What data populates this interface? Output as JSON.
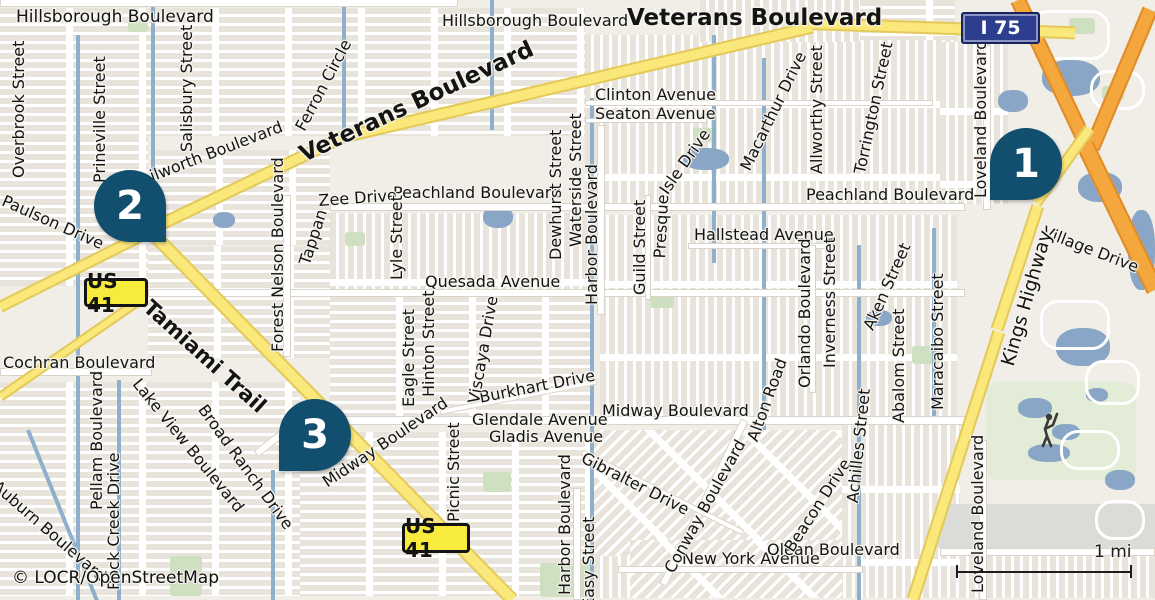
{
  "map": {
    "attribution": "© LOCR/OpenStreetMap",
    "scale_label": "1 mi",
    "colors": {
      "background": "#f1eee8",
      "block": "#e8e4db",
      "road_white": "#ffffff",
      "highway_yellow": "#fbe87a",
      "motorway_orange": "#f4a73d",
      "water": "#8fb0cc",
      "green": "#cfdfc2",
      "marker_blue": "#124e6e",
      "us_shield_bg": "#f7ec3d",
      "interstate_shield_bg": "#2e3e8e",
      "label_color": "#141414"
    },
    "shields": [
      {
        "name": "route-shield-us41-north",
        "label": "US 41",
        "type": "us",
        "x": 84,
        "y": 278,
        "w": 64,
        "h": 29
      },
      {
        "name": "route-shield-us41-south",
        "label": "US 41",
        "type": "us",
        "x": 402,
        "y": 523,
        "w": 68,
        "h": 30
      },
      {
        "name": "route-shield-i75",
        "label": "I 75",
        "type": "interstate",
        "x": 961,
        "y": 12,
        "w": 79,
        "h": 32
      }
    ],
    "markers": [
      {
        "name": "map-marker-1",
        "number": "1",
        "x": 990,
        "y": 128,
        "tail": "left"
      },
      {
        "name": "map-marker-2",
        "number": "2",
        "x": 94,
        "y": 170,
        "tail": "right"
      },
      {
        "name": "map-marker-3",
        "number": "3",
        "x": 279,
        "y": 399,
        "tail": "left"
      }
    ],
    "labels": [
      {
        "text": "Hillsborough Boulevard",
        "x": 16,
        "y": 9,
        "rot": 0,
        "size": 17
      },
      {
        "text": "Hillsborough Boulevard",
        "x": 442,
        "y": 13,
        "rot": 0,
        "size": 16
      },
      {
        "text": "Veterans Boulevard",
        "x": 627,
        "y": 6,
        "rot": 0,
        "size": 23,
        "bold": true,
        "name": "road-label-veterans-top"
      },
      {
        "text": "Veterans Boulevard",
        "x": 296,
        "y": 145,
        "rot": -25,
        "size": 23,
        "bold": true,
        "name": "road-label-veterans-diag"
      },
      {
        "text": "Clinton Avenue",
        "x": 595,
        "y": 87,
        "rot": 0,
        "size": 16
      },
      {
        "text": "Seaton Avenue",
        "x": 595,
        "y": 106,
        "rot": 0,
        "size": 16
      },
      {
        "text": "Peachland Boulevard",
        "x": 393,
        "y": 185,
        "rot": 0,
        "size": 16
      },
      {
        "text": "Peachland Boulevard",
        "x": 806,
        "y": 187,
        "rot": 0,
        "size": 16
      },
      {
        "text": "Quesada Avenue",
        "x": 425,
        "y": 274,
        "rot": 0,
        "size": 16
      },
      {
        "text": "Hallstead Avenue",
        "x": 694,
        "y": 227,
        "rot": 0,
        "size": 16
      },
      {
        "text": "Midway Boulevard",
        "x": 602,
        "y": 403,
        "rot": 0,
        "size": 16
      },
      {
        "text": "Glendale Avenue",
        "x": 472,
        "y": 412,
        "rot": 0,
        "size": 16
      },
      {
        "text": "Gladis Avenue",
        "x": 489,
        "y": 429,
        "rot": 0,
        "size": 16
      },
      {
        "text": "New York Avenue",
        "x": 682,
        "y": 551,
        "rot": 0,
        "size": 16
      },
      {
        "text": "Olean Boulevard",
        "x": 767,
        "y": 542,
        "rot": 0,
        "size": 16
      },
      {
        "text": "Cochran Boulevard",
        "x": 3,
        "y": 355,
        "rot": 0,
        "size": 16
      },
      {
        "text": "Burkhart Drive",
        "x": 478,
        "y": 390,
        "rot": -11,
        "size": 16
      },
      {
        "text": "Zee Drive",
        "x": 318,
        "y": 193,
        "rot": -4,
        "size": 16
      },
      {
        "text": "Tappan",
        "x": 297,
        "y": 262,
        "rot": -72,
        "size": 16
      },
      {
        "text": "Village Drive",
        "x": 1046,
        "y": 224,
        "rot": 21,
        "size": 16
      },
      {
        "text": "Kenilworth Boulevard",
        "x": 120,
        "y": 180,
        "rot": -21,
        "size": 16
      },
      {
        "text": "Tamiami Trail",
        "x": 154,
        "y": 296,
        "rot": 42,
        "size": 21,
        "bold": true,
        "name": "road-label-tamiami"
      },
      {
        "text": "Paulson Drive",
        "x": 6,
        "y": 193,
        "rot": 24,
        "size": 16
      },
      {
        "text": "Ferron Circle",
        "x": 293,
        "y": 126,
        "rot": -62,
        "size": 16
      },
      {
        "text": "Macarthur Drive",
        "x": 738,
        "y": 166,
        "rot": -64,
        "size": 16
      },
      {
        "text": "Torrington Street",
        "x": 852,
        "y": 172,
        "rot": -78,
        "size": 16
      },
      {
        "text": "Aken Street",
        "x": 861,
        "y": 326,
        "rot": -66,
        "size": 16
      },
      {
        "text": "Alton Road",
        "x": 745,
        "y": 438,
        "rot": -70,
        "size": 16
      },
      {
        "text": "Presque",
        "x": 652,
        "y": 258,
        "rot": -87,
        "size": 16
      },
      {
        "text": "Isle Drive",
        "x": 657,
        "y": 188,
        "rot": -55,
        "size": 16
      },
      {
        "text": "Kings Highway",
        "x": 999,
        "y": 363,
        "rot": -74,
        "size": 19,
        "name": "road-label-kings-highway"
      },
      {
        "text": "Midway Boulevard",
        "x": 320,
        "y": 477,
        "rot": -34,
        "size": 16
      },
      {
        "text": "Broad Ranch Drive",
        "x": 208,
        "y": 402,
        "rot": 54,
        "size": 16
      },
      {
        "text": "Lake View Boulevard",
        "x": 142,
        "y": 376,
        "rot": 51,
        "size": 16
      },
      {
        "text": "Auburn Boulevard",
        "x": 0,
        "y": 478,
        "rot": 41,
        "size": 16
      },
      {
        "text": "Gibralter Drive",
        "x": 586,
        "y": 450,
        "rot": 27,
        "size": 16
      },
      {
        "text": "Conway Boulevard",
        "x": 662,
        "y": 568,
        "rot": -61,
        "size": 16
      },
      {
        "text": "Beacon Drive",
        "x": 782,
        "y": 546,
        "rot": -57,
        "size": 16
      },
      {
        "text": "Overbrook Street",
        "x": 11,
        "y": 178,
        "rot": -90,
        "size": 16
      },
      {
        "text": "Prineville Street",
        "x": 92,
        "y": 183,
        "rot": -90,
        "size": 16
      },
      {
        "text": "Salisbury Street",
        "x": 179,
        "y": 152,
        "rot": -90,
        "size": 16
      },
      {
        "text": "Dewhurst Street",
        "x": 548,
        "y": 260,
        "rot": -90,
        "size": 16
      },
      {
        "text": "Waterside Street",
        "x": 568,
        "y": 247,
        "rot": -90,
        "size": 16
      },
      {
        "text": "Harbor Boulevard",
        "x": 584,
        "y": 305,
        "rot": -90,
        "size": 16
      },
      {
        "text": "Guild Street",
        "x": 632,
        "y": 295,
        "rot": -90,
        "size": 16
      },
      {
        "text": "Forest Nelson Boulevard",
        "x": 270,
        "y": 352,
        "rot": -90,
        "size": 16
      },
      {
        "text": "Lyle Street",
        "x": 389,
        "y": 280,
        "rot": -90,
        "size": 16
      },
      {
        "text": "Eagle Street",
        "x": 401,
        "y": 407,
        "rot": -90,
        "size": 16
      },
      {
        "text": "Hinton Street",
        "x": 421,
        "y": 397,
        "rot": -90,
        "size": 16
      },
      {
        "text": "Viscaya Drive",
        "x": 466,
        "y": 402,
        "rot": -80,
        "size": 16
      },
      {
        "text": "Picnic Street",
        "x": 446,
        "y": 522,
        "rot": -90,
        "size": 16
      },
      {
        "text": "Harbor Boulevard",
        "x": 557,
        "y": 595,
        "rot": -90,
        "size": 16
      },
      {
        "text": "Easy Street",
        "x": 581,
        "y": 608,
        "rot": -90,
        "size": 16
      },
      {
        "text": "Orlando Boulevard",
        "x": 797,
        "y": 388,
        "rot": -90,
        "size": 16
      },
      {
        "text": "Inverness Street",
        "x": 822,
        "y": 368,
        "rot": -90,
        "size": 16
      },
      {
        "text": "Allworthy Street",
        "x": 809,
        "y": 174,
        "rot": -90,
        "size": 16
      },
      {
        "text": "Abalom Street",
        "x": 891,
        "y": 423,
        "rot": -90,
        "size": 16
      },
      {
        "text": "Maracaibo Street",
        "x": 930,
        "y": 410,
        "rot": -90,
        "size": 16
      },
      {
        "text": "Achilles Street",
        "x": 845,
        "y": 502,
        "rot": -84,
        "size": 16
      },
      {
        "text": "Loveland Boulevard",
        "x": 973,
        "y": 198,
        "rot": -90,
        "size": 16
      },
      {
        "text": "Loveland Boulevard",
        "x": 970,
        "y": 593,
        "rot": -90,
        "size": 16
      },
      {
        "text": "Pellam Boulevard",
        "x": 89,
        "y": 510,
        "rot": -90,
        "size": 16
      },
      {
        "text": "Rock Creek Drive",
        "x": 106,
        "y": 590,
        "rot": -90,
        "size": 16
      }
    ]
  }
}
